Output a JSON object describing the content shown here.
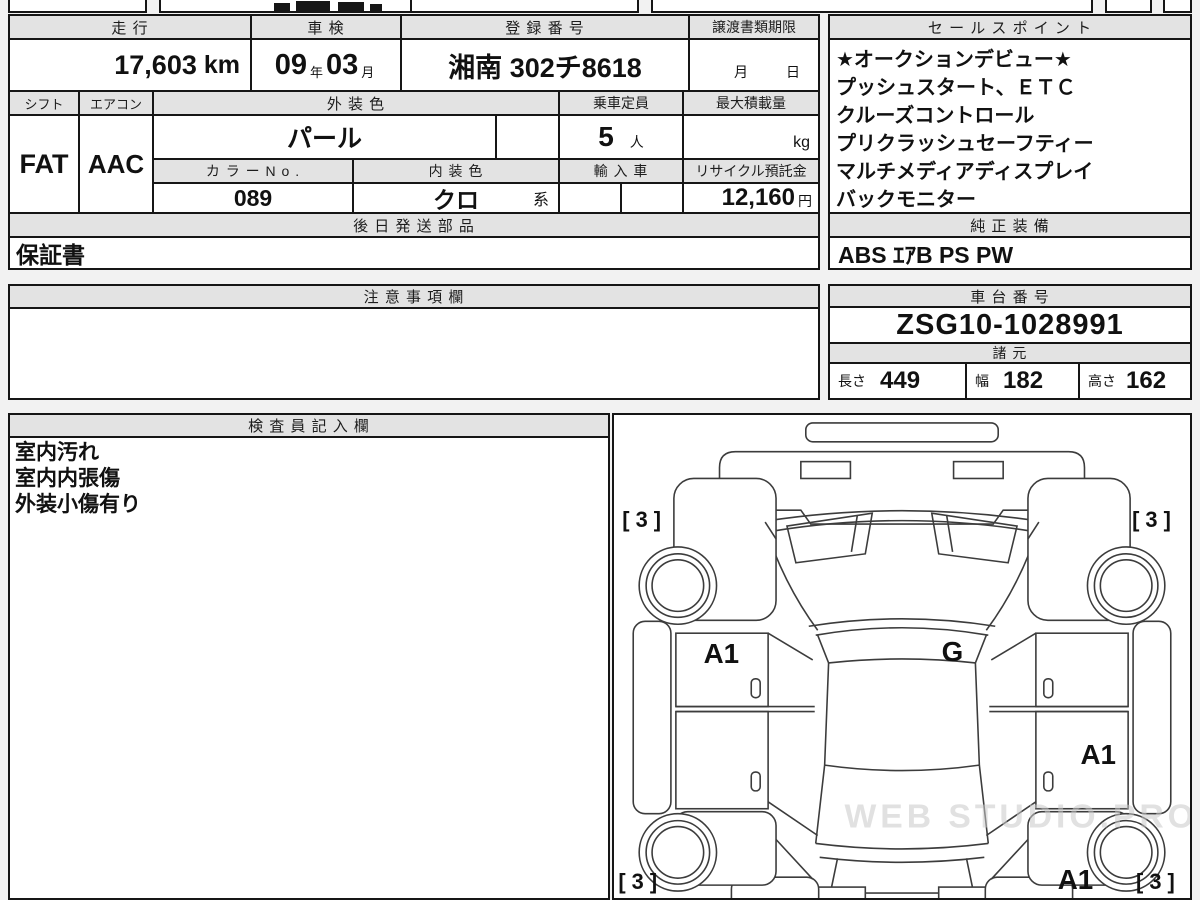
{
  "top": {
    "mileage": {
      "label": "走 行",
      "value": "17,603",
      "unit": "km"
    },
    "inspection": {
      "label": "車 検",
      "year": "09",
      "year_unit": "年",
      "month": "03",
      "month_unit": "月"
    },
    "registration": {
      "label": "登 録 番 号",
      "value": "湘南 302チ8618"
    },
    "transfer_deadline": {
      "label": "譲渡書類期限",
      "month_unit": "月",
      "day_unit": "日"
    },
    "shift": {
      "label": "シフト",
      "value": "FAT"
    },
    "aircon": {
      "label": "エアコン",
      "value": "AAC"
    },
    "exterior_color": {
      "label": "外 装 色",
      "value": "パール"
    },
    "color_no": {
      "label": "カ ラ ー N o .",
      "value": "089"
    },
    "interior_color": {
      "label": "内 装 色",
      "value": "クロ",
      "suffix": "系"
    },
    "capacity": {
      "label": "乗車定員",
      "value": "5",
      "unit": "人"
    },
    "max_load": {
      "label": "最大積載量",
      "unit": "kg"
    },
    "import_car": {
      "label": "輸 入 車"
    },
    "recycle": {
      "label": "リサイクル預託金",
      "value": "12,160",
      "unit": "円"
    }
  },
  "sales_points": {
    "label": "セ ー ル ス ポ イ ン ト",
    "items": [
      "★オークションデビュー★",
      "プッシュスタート、ＥＴＣ",
      "クルーズコントロール",
      "プリクラッシュセーフティー",
      "マルチメディアディスプレイ",
      "バックモニター"
    ]
  },
  "later_shipping": {
    "label": "後 日 発 送 部 品",
    "value": "保証書"
  },
  "genuine_equipment": {
    "label": "純 正 装 備",
    "value": "ABS ｴｱB PS PW"
  },
  "notes": {
    "label": "注 意 事 項 欄",
    "value": ""
  },
  "chassis": {
    "label": "車 台 番 号",
    "value": "ZSG10-1028991"
  },
  "specs": {
    "label": "諸 元",
    "length_label": "長さ",
    "length": "449",
    "width_label": "幅",
    "width": "182",
    "height_label": "高さ",
    "height": "162"
  },
  "inspector": {
    "label": "検 査 員 記 入 欄",
    "lines": [
      "室内汚れ",
      "室内内張傷",
      "外装小傷有り"
    ]
  },
  "diagram": {
    "corner_front_left": "[ 3 ]",
    "corner_front_right": "[ 3 ]",
    "corner_rear_left": "[ 3 ]",
    "corner_rear_right": "[ 3 ]",
    "label_front_left_door": "A1",
    "label_center": "G",
    "label_rear_right_door": "A1",
    "label_rear_right_quarter": "A1",
    "watermark": "WEB STUDIO.PRO"
  },
  "colors": {
    "page_bg": "#f2f2f2",
    "header_bg": "#e3e3e3",
    "border": "#161616",
    "line_art": "#3c3c3c"
  }
}
